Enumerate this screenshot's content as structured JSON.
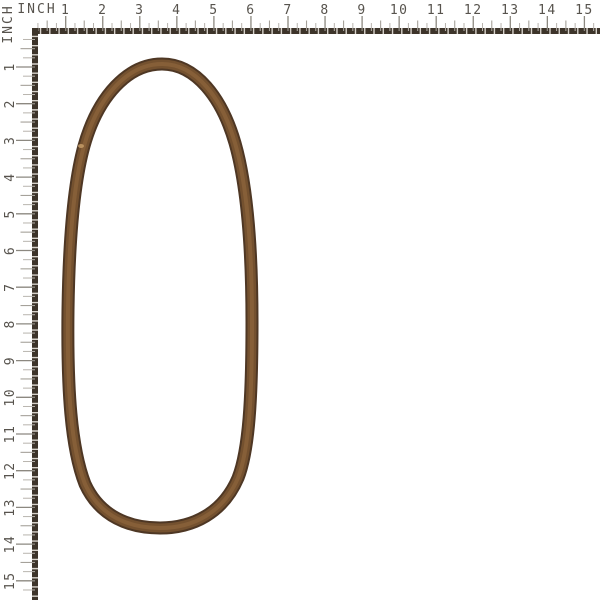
{
  "page": {
    "background": "#ffffff",
    "description": "Product photo of a brown rubber V-belt loop on white, with inch measurement rulers along the top and left edges"
  },
  "rulers": {
    "unit_label": "INCH",
    "top_numbers": [
      "1",
      "2",
      "3",
      "4",
      "5",
      "6",
      "7",
      "8",
      "9",
      "10",
      "11",
      "12",
      "13",
      "14",
      "15"
    ],
    "left_numbers": [
      "1",
      "2",
      "3",
      "4",
      "5",
      "6",
      "7",
      "8",
      "9",
      "10",
      "11",
      "12",
      "13",
      "14",
      "15"
    ],
    "colors": {
      "bar_dash": "#3d342a",
      "bar_gap": "#d8d3cc",
      "major_tick": "#8c8880",
      "half_tick": "#a5a19a",
      "quarter_tick": "#b8b4ae",
      "number_text": "#57534d",
      "label_text": "#57534d"
    }
  },
  "belt": {
    "label": "v-belt",
    "color_edge": "#4e3724",
    "color_body": "#74512f",
    "color_center": "#8a6239",
    "scuff_color": "#c9a06a"
  }
}
